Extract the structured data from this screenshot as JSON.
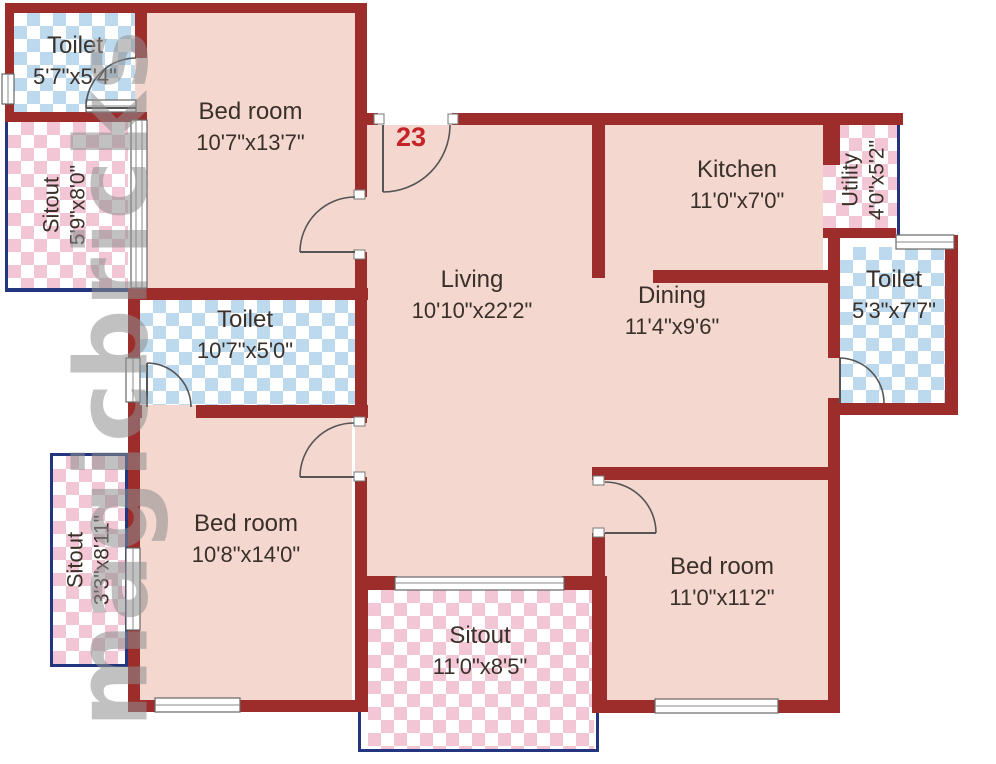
{
  "watermark": "magicbricks",
  "unit_number": "23",
  "rooms": {
    "toilet_top_left": {
      "name": "Toilet",
      "dims": "5'7\"x5'4\""
    },
    "sitout_left_upper": {
      "name": "Sitout",
      "dims": "5'9\"x8'0\""
    },
    "bedroom_top": {
      "name": "Bed room",
      "dims": "10'7\"x13'7\""
    },
    "toilet_mid_left": {
      "name": "Toilet",
      "dims": "10'7\"x5'0\""
    },
    "bedroom_left": {
      "name": "Bed room",
      "dims": "10'8\"x14'0\""
    },
    "sitout_left_lower": {
      "name": "Sitout",
      "dims": "3'3\"x8'11\""
    },
    "living": {
      "name": "Living",
      "dims": "10'10\"x22'2\""
    },
    "dining": {
      "name": "Dining",
      "dims": "11'4\"x9'6\""
    },
    "kitchen": {
      "name": "Kitchen",
      "dims": "11'0\"x7'0\""
    },
    "utility": {
      "name": "Utility",
      "dims": "4'0\"x5'2\""
    },
    "toilet_right": {
      "name": "Toilet",
      "dims": "5'3\"x7'7\""
    },
    "bedroom_bottom_right": {
      "name": "Bed room",
      "dims": "11'0\"x11'2\""
    },
    "sitout_bottom": {
      "name": "Sitout",
      "dims": "11'0\"x8'5\""
    }
  },
  "colors": {
    "wall": "#9c2d2b",
    "room_fill": "#f4d7cf",
    "checker_blue": "#bcd9ee",
    "checker_pink": "#f2c6d5",
    "balcony_border": "#23357d",
    "unit_number_red": "#c32427",
    "watermark_gray": "#8f8f8f"
  }
}
